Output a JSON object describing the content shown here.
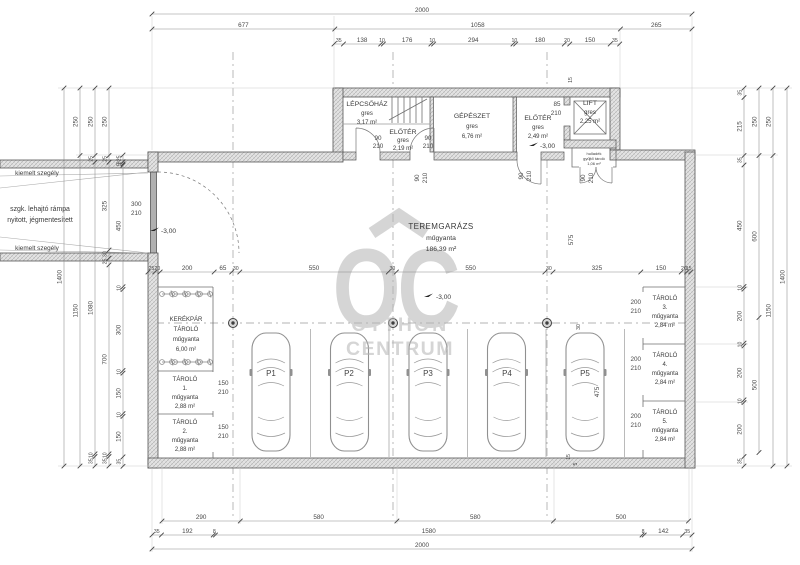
{
  "watermark": {
    "monogram": "OC",
    "name1": "OTTHON",
    "name2": "CENTRUM"
  },
  "rooms": {
    "lepcsohaz": {
      "name": "LÉPCSŐHÁZ",
      "finish": "gres",
      "area": "3,17 m²"
    },
    "eloter1": {
      "name": "ELŐTÉR",
      "finish": "gres",
      "area": "2,19 m²"
    },
    "gepeszet": {
      "name": "GÉPÉSZET",
      "finish": "gres",
      "area": "6,76 m²"
    },
    "eloter2": {
      "name": "ELŐTÉR",
      "finish": "gres",
      "area": "2,49 m²"
    },
    "lift": {
      "name": "LIFT",
      "finish": "gres",
      "area": "2,25 m²"
    },
    "kisraktar": {
      "line1": "hulladék",
      "line2": "gyűjtő tároló",
      "line3": "1,06 m²"
    },
    "teremgarazs": {
      "name": "TEREMGARÁZS",
      "finish": "műgyanta",
      "area": "186,39 m²"
    },
    "kerekpartarolo": {
      "name1": "KERÉKPÁR",
      "name2": "TÁROLÓ",
      "finish": "műgyanta",
      "area": "6,00 m²"
    },
    "tarolo1": {
      "name": "TÁROLÓ",
      "num": "1.",
      "finish": "műgyanta",
      "area": "2,88 m²"
    },
    "tarolo2": {
      "name": "TÁROLÓ",
      "num": "2.",
      "finish": "műgyanta",
      "area": "2,88 m²"
    },
    "tarolo3": {
      "name": "TÁROLÓ",
      "num": "3.",
      "finish": "műgyanta",
      "area": "2,84 m²"
    },
    "tarolo4": {
      "name": "TÁROLÓ",
      "num": "4.",
      "finish": "műgyanta",
      "area": "2,84 m²"
    },
    "tarolo5": {
      "name": "TÁROLÓ",
      "num": "5.",
      "finish": "műgyanta",
      "area": "2,84 m²"
    }
  },
  "parking": {
    "p1": "P1",
    "p2": "P2",
    "p3": "P3",
    "p4": "P4",
    "p5": "P5"
  },
  "levels": {
    "value": "-3,00"
  },
  "annotations": {
    "curb": "kiemelt szegély",
    "ramp1": "szgk. lehajtó rámpa",
    "ramp2": "nyitott, jégmentesített"
  },
  "doors": {
    "w90": "90",
    "w85": "85",
    "w150": "150",
    "w200": "200",
    "w300": "300",
    "h210": "210"
  },
  "dims": {
    "top1": [
      "2000"
    ],
    "top2": [
      "677",
      "1058",
      "265"
    ],
    "top3": [
      "35",
      "138",
      "10",
      "176",
      "10",
      "294",
      "10",
      "180",
      "20",
      "150",
      "35"
    ],
    "mid": [
      "25",
      "20",
      "200",
      "65",
      "30",
      "550",
      "30",
      "550",
      "30",
      "325",
      "150",
      "20",
      "15"
    ],
    "bottom1": [
      "290",
      "580",
      "580",
      "500"
    ],
    "bottom2": [
      "35",
      "192",
      "8",
      "1580",
      "8",
      "142",
      "35"
    ],
    "bottom3": [
      "2000"
    ],
    "left1": [
      "1400"
    ],
    "left2": [
      "250",
      "1150"
    ],
    "left3": [
      "250",
      "25",
      "1080",
      "10",
      "35"
    ],
    "left4": [
      "250",
      "25",
      "325",
      "30",
      "25",
      "700",
      "10",
      "35"
    ],
    "left5": [
      "25",
      "8",
      "5",
      "450",
      "10",
      "300",
      "10",
      "150",
      "10",
      "150",
      "35"
    ],
    "right1": [
      "35",
      "215",
      "35",
      "450",
      "10",
      "200",
      "10",
      "200",
      "10",
      "200",
      "35"
    ],
    "right2": [
      "250",
      "600",
      "500"
    ],
    "right3": [
      "250",
      "1150"
    ],
    "right4": [
      "1400"
    ],
    "inner": {
      "d575": "575",
      "d475": "475",
      "d30": "30",
      "d15": "15",
      "d5": "5"
    }
  }
}
